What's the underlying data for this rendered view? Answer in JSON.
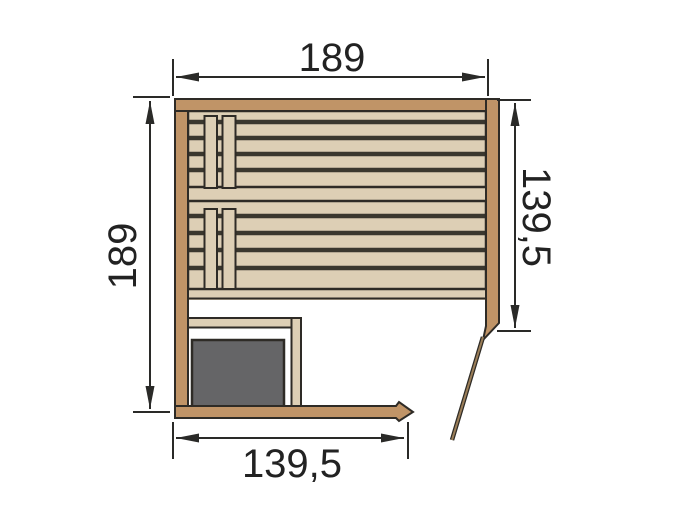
{
  "diagram": {
    "title": "Sauna floor plan (top view)",
    "type": "technical-drawing",
    "dimensions": {
      "width_top": "189",
      "height_left": "189",
      "interior_height_right": "139,5",
      "door_side_width_bottom": "139,5"
    },
    "elements": {
      "walls": "wooden wall planks",
      "benches": 2,
      "bench_support_boards_per_bench": 2,
      "heater": "sauna heater",
      "heater_guard": "L-shaped heater guard rail",
      "door": "open door leaf at bottom-right corner"
    },
    "colors": {
      "wall-brown": "#c09467",
      "wood-beige": "#ddcfb5",
      "outline-dark": "#2e2b26",
      "slat-gap": "#3a372e",
      "heater-gray": "#656567",
      "door-brown": "#9b7e58",
      "dim-line": "#2a2a28",
      "background": "#ffffff"
    }
  }
}
